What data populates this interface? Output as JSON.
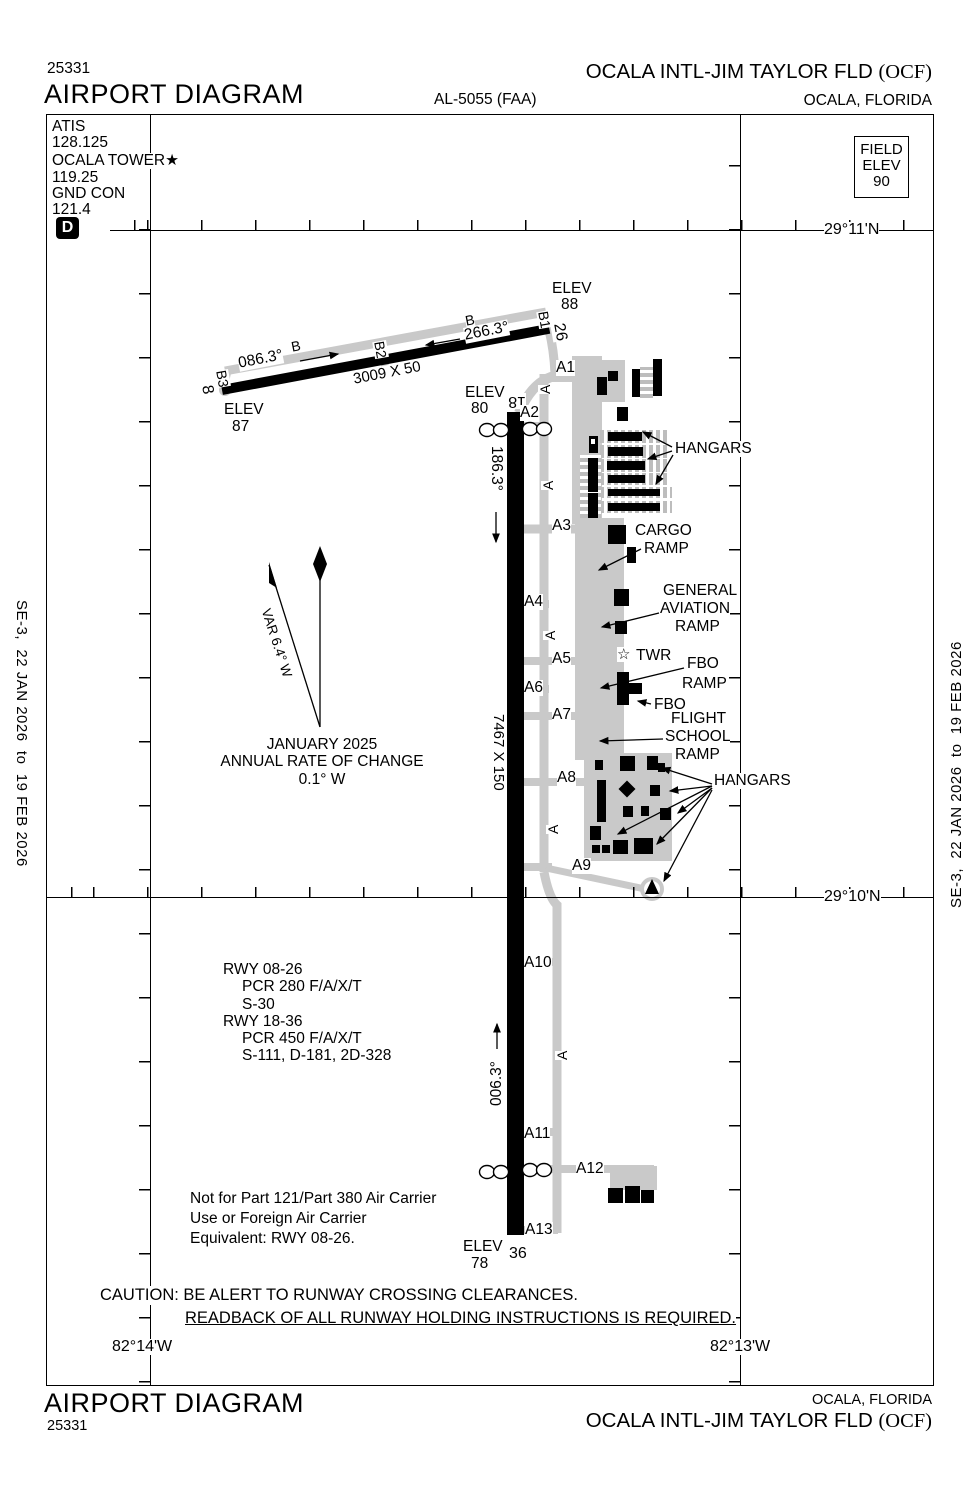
{
  "header": {
    "chart_number": "25331",
    "title": "AIRPORT DIAGRAM",
    "procedure_code": "AL-5055 (FAA)",
    "airport_name": "OCALA INTL-JIM TAYLOR FLD",
    "airport_icao": "(OCF)",
    "city": "OCALA, FLORIDA"
  },
  "footer": {
    "chart_number": "25331",
    "title": "AIRPORT DIAGRAM",
    "airport_name": "OCALA INTL-JIM TAYLOR FLD",
    "airport_icao": "(OCF)",
    "city": "OCALA, FLORIDA"
  },
  "margin_note": "SE-3,  22 JAN 2026  to  19 FEB 2026",
  "comm": {
    "l1": "ATIS",
    "l2": "128.125",
    "l3": "OCALA TOWER★",
    "l4": "119.25",
    "l5": "GND CON",
    "l6": "121.4",
    "d_symbol": "D"
  },
  "field_elev": {
    "l1": "FIELD",
    "l2": "ELEV",
    "l3": "90"
  },
  "grid": {
    "lat1": "29°11'N",
    "lat2": "29°10'N",
    "lon1": "82°14'W",
    "lon2": "82°13'W"
  },
  "variation": {
    "l1": "JANUARY 2025",
    "l2": "ANNUAL RATE OF CHANGE",
    "l3": "0.1° W"
  },
  "rwy_data": {
    "l1": "RWY 08-26",
    "l2": "PCR 280 F/A/X/T",
    "l3": "S-30",
    "l4": "RWY 18-36",
    "l5": "PCR 450 F/A/X/T",
    "l6": "S-111, D-181, 2D-328"
  },
  "part121": {
    "l1": "Not for Part 121/Part 380 Air Carrier",
    "l2": "Use or Foreign Air Carrier",
    "l3": "Equivalent: RWY 08-26."
  },
  "caution": {
    "line1": "CAUTION: BE ALERT TO RUNWAY CROSSING CLEARANCES.",
    "line2": "READBACK OF ALL RUNWAY HOLDING INSTRUCTIONS IS REQUIRED."
  },
  "map_labels": [
    {
      "n": "elev-26-end",
      "t": "ELEV",
      "x": 552,
      "y": 281
    },
    {
      "n": "elev-26-end-value",
      "t": "88",
      "x": 561,
      "y": 297
    },
    {
      "n": "elev-08-end",
      "t": "ELEV",
      "x": 224,
      "y": 402
    },
    {
      "n": "elev-08-end-value",
      "t": "87",
      "x": 232,
      "y": 419
    },
    {
      "n": "elev-18-end",
      "t": "ELEV",
      "x": 465,
      "y": 385
    },
    {
      "n": "elev-18-end-value",
      "t": "80",
      "x": 471,
      "y": 401
    },
    {
      "n": "elev-36-end",
      "t": "ELEV",
      "x": 463,
      "y": 1239
    },
    {
      "n": "elev-36-end-value",
      "t": "78",
      "x": 471,
      "y": 1256
    },
    {
      "n": "rwy36-number",
      "t": "36",
      "x": 509,
      "y": 1246,
      "s": 16
    },
    {
      "n": "rwy18-number",
      "t": "18",
      "x": 526,
      "y": 409,
      "r": 180,
      "s": 16
    },
    {
      "n": "rwy08-number",
      "t": "8",
      "x": 214,
      "y": 384,
      "r": 80,
      "s": 16
    },
    {
      "n": "rwy26-number",
      "t": "26",
      "x": 566,
      "y": 322,
      "r": 80,
      "s": 16
    },
    {
      "n": "twy-b1",
      "t": "B1",
      "x": 550,
      "y": 310,
      "r": 80,
      "s": 14
    },
    {
      "n": "twy-b2",
      "t": "B2",
      "x": 386,
      "y": 340,
      "r": 80,
      "s": 14
    },
    {
      "n": "twy-b3",
      "t": "B3",
      "x": 228,
      "y": 369,
      "r": 80,
      "s": 14
    },
    {
      "n": "twy-b",
      "t": "B",
      "x": 290,
      "y": 340,
      "r": -11,
      "s": 14
    },
    {
      "n": "twy-b",
      "t": "B",
      "x": 464,
      "y": 314,
      "r": -11,
      "s": 14
    },
    {
      "n": "rwy08-heading",
      "t": "086.3°",
      "x": 237,
      "y": 356,
      "r": -11
    },
    {
      "n": "rwy26-heading",
      "t": "266.3°",
      "x": 463,
      "y": 328,
      "r": -11
    },
    {
      "n": "rwy0826-dimensions",
      "t": "3009 X 50",
      "x": 352,
      "y": 372,
      "r": -11,
      "s": 15
    },
    {
      "n": "rwy18-heading",
      "t": "186.3°",
      "x": 504,
      "y": 446,
      "r": 90
    },
    {
      "n": "rwy1836-dimensions",
      "t": "7467 X 150",
      "x": 506,
      "y": 714,
      "r": 90,
      "s": 15
    },
    {
      "n": "rwy36-heading",
      "t": "006.3°",
      "x": 489,
      "y": 1106,
      "r": -90
    },
    {
      "n": "twy-a1",
      "t": "A1",
      "x": 556,
      "y": 360
    },
    {
      "n": "twy-a2",
      "t": "A2",
      "x": 520,
      "y": 405
    },
    {
      "n": "twy-a3",
      "t": "A3",
      "x": 552,
      "y": 518
    },
    {
      "n": "twy-a4",
      "t": "A4",
      "x": 524,
      "y": 594
    },
    {
      "n": "twy-a5",
      "t": "A5",
      "x": 552,
      "y": 651
    },
    {
      "n": "twy-a6",
      "t": "A6",
      "x": 524,
      "y": 680
    },
    {
      "n": "twy-a7",
      "t": "A7",
      "x": 552,
      "y": 707
    },
    {
      "n": "twy-a8",
      "t": "A8",
      "x": 557,
      "y": 770
    },
    {
      "n": "twy-a9",
      "t": "A9",
      "x": 572,
      "y": 858
    },
    {
      "n": "twy-a10",
      "t": "A10",
      "x": 524,
      "y": 955
    },
    {
      "n": "twy-a11",
      "t": "A11",
      "x": 524,
      "y": 1126
    },
    {
      "n": "twy-a12",
      "t": "A12",
      "x": 576,
      "y": 1161
    },
    {
      "n": "twy-a13",
      "t": "A13",
      "x": 525,
      "y": 1222
    },
    {
      "n": "twy-a",
      "t": "A",
      "x": 538,
      "y": 394,
      "r": -90,
      "s": 14
    },
    {
      "n": "twy-a",
      "t": "A",
      "x": 541,
      "y": 490,
      "r": -90,
      "s": 14
    },
    {
      "n": "twy-a",
      "t": "A",
      "x": 543,
      "y": 640,
      "r": -90,
      "s": 14
    },
    {
      "n": "twy-a",
      "t": "A",
      "x": 546,
      "y": 834,
      "r": -90,
      "s": 14
    },
    {
      "n": "twy-a",
      "t": "A",
      "x": 555,
      "y": 1060,
      "r": -90,
      "s": 14
    },
    {
      "n": "hangars-label-north",
      "t": "HANGARS",
      "x": 675,
      "y": 441
    },
    {
      "n": "cargo-ramp-label",
      "t": "CARGO",
      "x": 635,
      "y": 523
    },
    {
      "n": "cargo-ramp-label",
      "t": "RAMP",
      "x": 644,
      "y": 541
    },
    {
      "n": "ga-ramp-label",
      "t": "GENERAL",
      "x": 663,
      "y": 583
    },
    {
      "n": "ga-ramp-label",
      "t": "AVIATION",
      "x": 660,
      "y": 601
    },
    {
      "n": "ga-ramp-label",
      "t": "RAMP",
      "x": 675,
      "y": 619
    },
    {
      "n": "tower-star-icon",
      "t": "☆",
      "x": 617,
      "y": 647,
      "s": 15
    },
    {
      "n": "tower-label",
      "t": "TWR",
      "x": 636,
      "y": 648
    },
    {
      "n": "fbo-ramp-label",
      "t": "FBO",
      "x": 687,
      "y": 656
    },
    {
      "n": "fbo-ramp-label",
      "t": "RAMP",
      "x": 682,
      "y": 676
    },
    {
      "n": "fbo-label",
      "t": "FBO",
      "x": 654,
      "y": 697
    },
    {
      "n": "flight-school-label",
      "t": "FLIGHT",
      "x": 671,
      "y": 711
    },
    {
      "n": "flight-school-label",
      "t": "SCHOOL",
      "x": 665,
      "y": 729
    },
    {
      "n": "flight-school-label",
      "t": "RAMP",
      "x": 675,
      "y": 747
    },
    {
      "n": "hangars-label-south",
      "t": "HANGARS",
      "x": 714,
      "y": 773
    },
    {
      "n": "var-label",
      "t": "VAR 6.4° W",
      "x": 272,
      "y": 607,
      "r": 72,
      "s": 13.5
    },
    {
      "n": "lat-label",
      "t": "29°11'N",
      "x": 824,
      "y": 222,
      "s": 16
    },
    {
      "n": "lat-label",
      "t": "29°10'N",
      "x": 824,
      "y": 889,
      "s": 16
    },
    {
      "n": "lon-label",
      "t": "82°14'W",
      "x": 112,
      "y": 1339,
      "s": 16
    },
    {
      "n": "lon-label",
      "t": "82°13'W",
      "x": 710,
      "y": 1339,
      "s": 16
    }
  ],
  "geometry": {
    "aprons": [
      {
        "x": 553,
        "y": 366,
        "w": 26,
        "h": 16
      },
      {
        "x": 578,
        "y": 360,
        "w": 47,
        "h": 42
      },
      {
        "x": 572,
        "y": 356,
        "w": 30,
        "h": 168
      },
      {
        "x": 575,
        "y": 518,
        "w": 49,
        "h": 242
      },
      {
        "x": 584,
        "y": 753,
        "w": 88,
        "h": 108
      },
      {
        "x": 610,
        "y": 1166,
        "w": 47,
        "h": 24
      }
    ],
    "hatch_rows": [
      {
        "x": 600,
        "y": 430,
        "w": 68,
        "h": 13
      },
      {
        "x": 600,
        "y": 445,
        "w": 68,
        "h": 13
      },
      {
        "x": 600,
        "y": 459,
        "w": 70,
        "h": 13
      },
      {
        "x": 600,
        "y": 473,
        "w": 70,
        "h": 12
      },
      {
        "x": 600,
        "y": 487,
        "w": 72,
        "h": 11
      },
      {
        "x": 600,
        "y": 501,
        "w": 72,
        "h": 12
      }
    ],
    "hatch_cols": [
      {
        "x": 640,
        "y": 367,
        "w": 13,
        "h": 31
      },
      {
        "x": 580,
        "y": 455,
        "w": 21,
        "h": 63
      }
    ],
    "buildings": [
      {
        "x": 597,
        "y": 377,
        "w": 10,
        "h": 18
      },
      {
        "x": 608,
        "y": 371,
        "w": 10,
        "h": 10
      },
      {
        "x": 632,
        "y": 369,
        "w": 8,
        "h": 28
      },
      {
        "x": 653,
        "y": 359,
        "w": 9,
        "h": 37
      },
      {
        "x": 617,
        "y": 407,
        "w": 11,
        "h": 14
      },
      {
        "x": 608,
        "y": 432,
        "w": 34,
        "h": 9
      },
      {
        "x": 608,
        "y": 447,
        "w": 35,
        "h": 9
      },
      {
        "x": 607,
        "y": 461,
        "w": 38,
        "h": 9
      },
      {
        "x": 608,
        "y": 475,
        "w": 37,
        "h": 8
      },
      {
        "x": 608,
        "y": 489,
        "w": 52,
        "h": 7
      },
      {
        "x": 608,
        "y": 503,
        "w": 52,
        "h": 8
      },
      {
        "x": 588,
        "y": 458,
        "w": 10,
        "h": 34
      },
      {
        "x": 588,
        "y": 493,
        "w": 10,
        "h": 25
      },
      {
        "x": 608,
        "y": 525,
        "w": 18,
        "h": 19
      },
      {
        "x": 627,
        "y": 547,
        "w": 9,
        "h": 16
      },
      {
        "x": 614,
        "y": 589,
        "w": 15,
        "h": 17
      },
      {
        "x": 615,
        "y": 621,
        "w": 12,
        "h": 13
      },
      {
        "x": 617,
        "y": 672,
        "w": 12,
        "h": 33
      },
      {
        "x": 629,
        "y": 683,
        "w": 13,
        "h": 11
      },
      {
        "x": 595,
        "y": 760,
        "w": 8,
        "h": 10
      },
      {
        "x": 620,
        "y": 756,
        "w": 15,
        "h": 15
      },
      {
        "x": 647,
        "y": 756,
        "w": 11,
        "h": 14
      },
      {
        "x": 658,
        "y": 763,
        "w": 7,
        "h": 9
      },
      {
        "x": 597,
        "y": 780,
        "w": 9,
        "h": 42
      },
      {
        "x": 621,
        "y": 783,
        "w": 12,
        "h": 12,
        "r": 45
      },
      {
        "x": 650,
        "y": 785,
        "w": 10,
        "h": 11
      },
      {
        "x": 623,
        "y": 806,
        "w": 10,
        "h": 11
      },
      {
        "x": 641,
        "y": 806,
        "w": 8,
        "h": 10
      },
      {
        "x": 660,
        "y": 808,
        "w": 11,
        "h": 12
      },
      {
        "x": 590,
        "y": 826,
        "w": 11,
        "h": 14
      },
      {
        "x": 592,
        "y": 845,
        "w": 8,
        "h": 8
      },
      {
        "x": 602,
        "y": 845,
        "w": 8,
        "h": 8
      },
      {
        "x": 613,
        "y": 840,
        "w": 15,
        "h": 14
      },
      {
        "x": 634,
        "y": 838,
        "w": 19,
        "h": 16
      },
      {
        "x": 608,
        "y": 1188,
        "w": 15,
        "h": 15
      },
      {
        "x": 625,
        "y": 1186,
        "w": 15,
        "h": 17
      },
      {
        "x": 641,
        "y": 1190,
        "w": 13,
        "h": 13
      }
    ]
  }
}
